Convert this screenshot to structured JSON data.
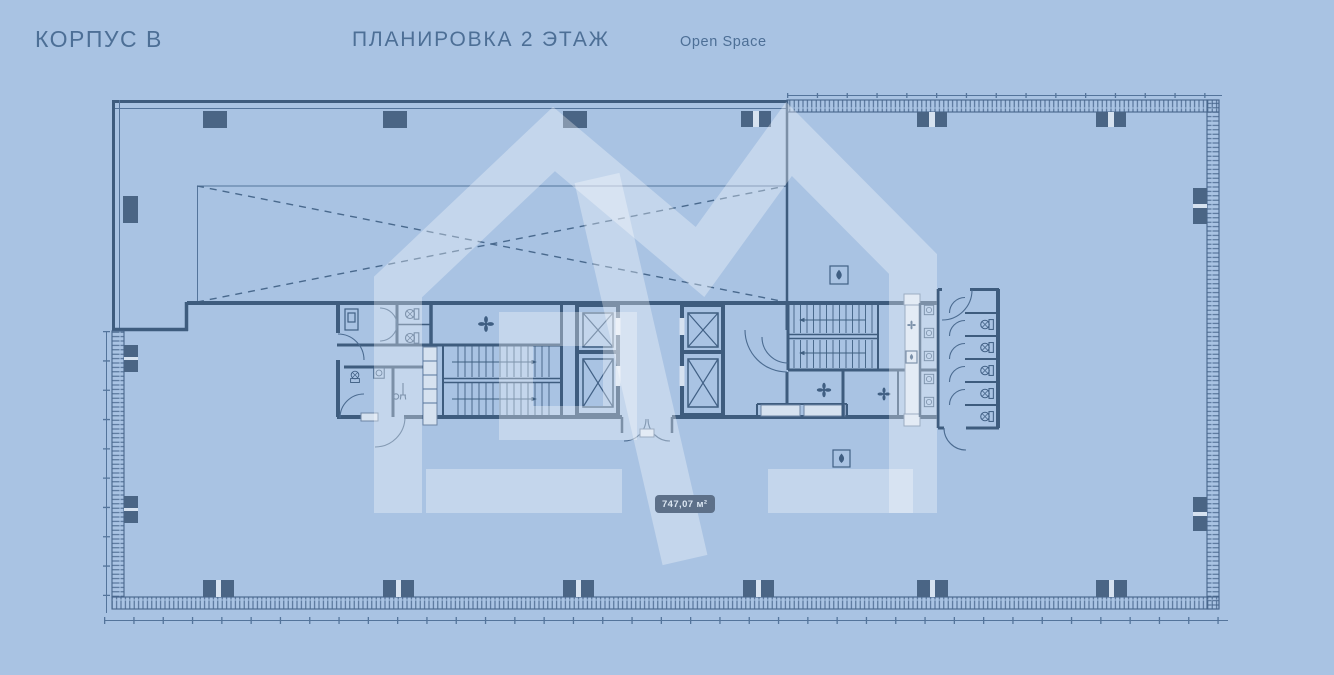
{
  "header": {
    "building": "КОРПУС B",
    "title": "ПЛАНИРОВКА 2 ЭТАЖ",
    "subtitle": "Open Space"
  },
  "plan": {
    "area_label": "747,07 м²",
    "floor_elements": [
      "open-space",
      "void-dashed-zone",
      "elevator-bank-1",
      "elevator-bank-2",
      "stairwell-left",
      "stairwell-right",
      "wc-block-left",
      "wc-block-right",
      "curtain-wall-hatched",
      "columns"
    ],
    "icons": [
      "fan-icon",
      "water-drop-icon",
      "toilet-icon",
      "sink-icon",
      "mop-icon",
      "elevator-cabin-icon",
      "door-swing-arc"
    ]
  },
  "colors": {
    "background": "#a9c3e3",
    "plan_line": "#3e5c7e",
    "plan_thin": "#54749b",
    "column_fill": "#4a6585",
    "light_fill": "#d6e2f0",
    "watermark": "rgba(255,255,255,0.32)",
    "badge_bg": "#5d7089",
    "badge_text": "#dbe6f2",
    "header_text": "#4d6f96"
  }
}
